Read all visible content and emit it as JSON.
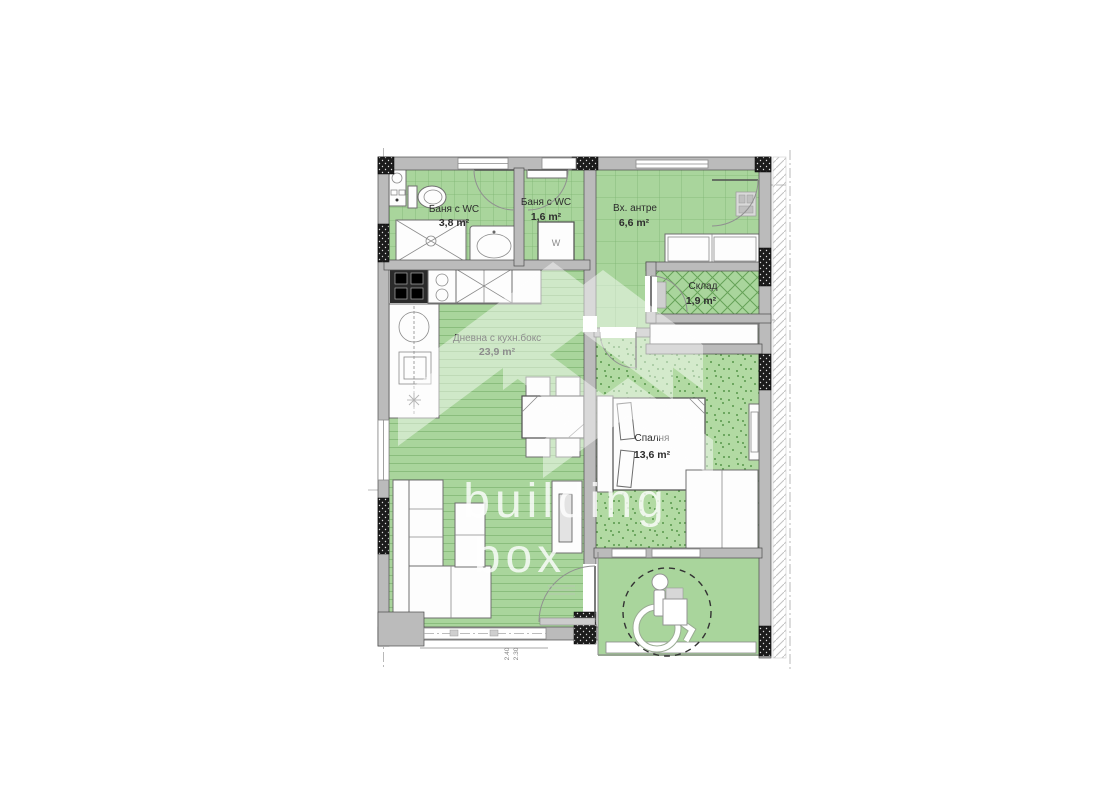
{
  "watermark": {
    "line1": "building",
    "line2": "box"
  },
  "rooms": {
    "bath1": {
      "name": "Баня с WC",
      "area": "3,8 m²"
    },
    "bath2": {
      "name": "Баня с WC",
      "area": "1,6 m²"
    },
    "hall": {
      "name": "Вх. антре",
      "area": "6,6 m²"
    },
    "storage": {
      "name": "Склад",
      "area": "1,9 m²"
    },
    "living": {
      "name": "Дневна с кухн.бокс",
      "area": "23,9 m²"
    },
    "bedroom": {
      "name": "Спалня",
      "area": "13,6 m²"
    }
  },
  "labels": {
    "washer": "W"
  },
  "dimensions": {
    "d1": "2.40",
    "d2": "2.30"
  },
  "colors": {
    "room_green": "#a9d59c",
    "grid_green": "#7fb573",
    "stipple_green": "#b2daa3",
    "stipple_dot": "#57974a",
    "wall_gray": "#bbbbbb",
    "column_black": "#1c1c1c",
    "text": "#2d2d2d",
    "watermark_white": "#ffffff"
  }
}
